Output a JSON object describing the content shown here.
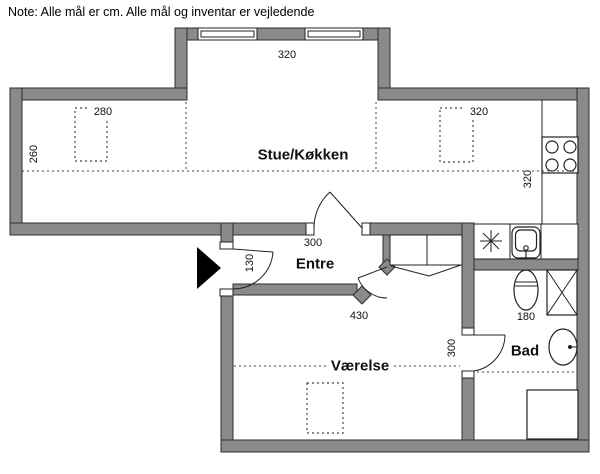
{
  "note": "Note: Alle mål er cm. Alle mål og inventar er vejledende",
  "rooms": {
    "living_kitchen": "Stue/Køkken",
    "entrance": "Entre",
    "bedroom": "Værelse",
    "bathroom": "Bad"
  },
  "dims": {
    "bay_window_width": "320",
    "living_left_item": "280",
    "living_left_depth": "260",
    "living_right_item": "320",
    "kitchen_depth": "320",
    "entrance_width": "300",
    "entrance_door_width": "130",
    "bedroom_width": "430",
    "bedroom_depth": "300",
    "bathroom_width": "180"
  },
  "colors": {
    "wall": "#8a8a8a",
    "outline": "#2e2e2e",
    "background": "#ffffff"
  }
}
